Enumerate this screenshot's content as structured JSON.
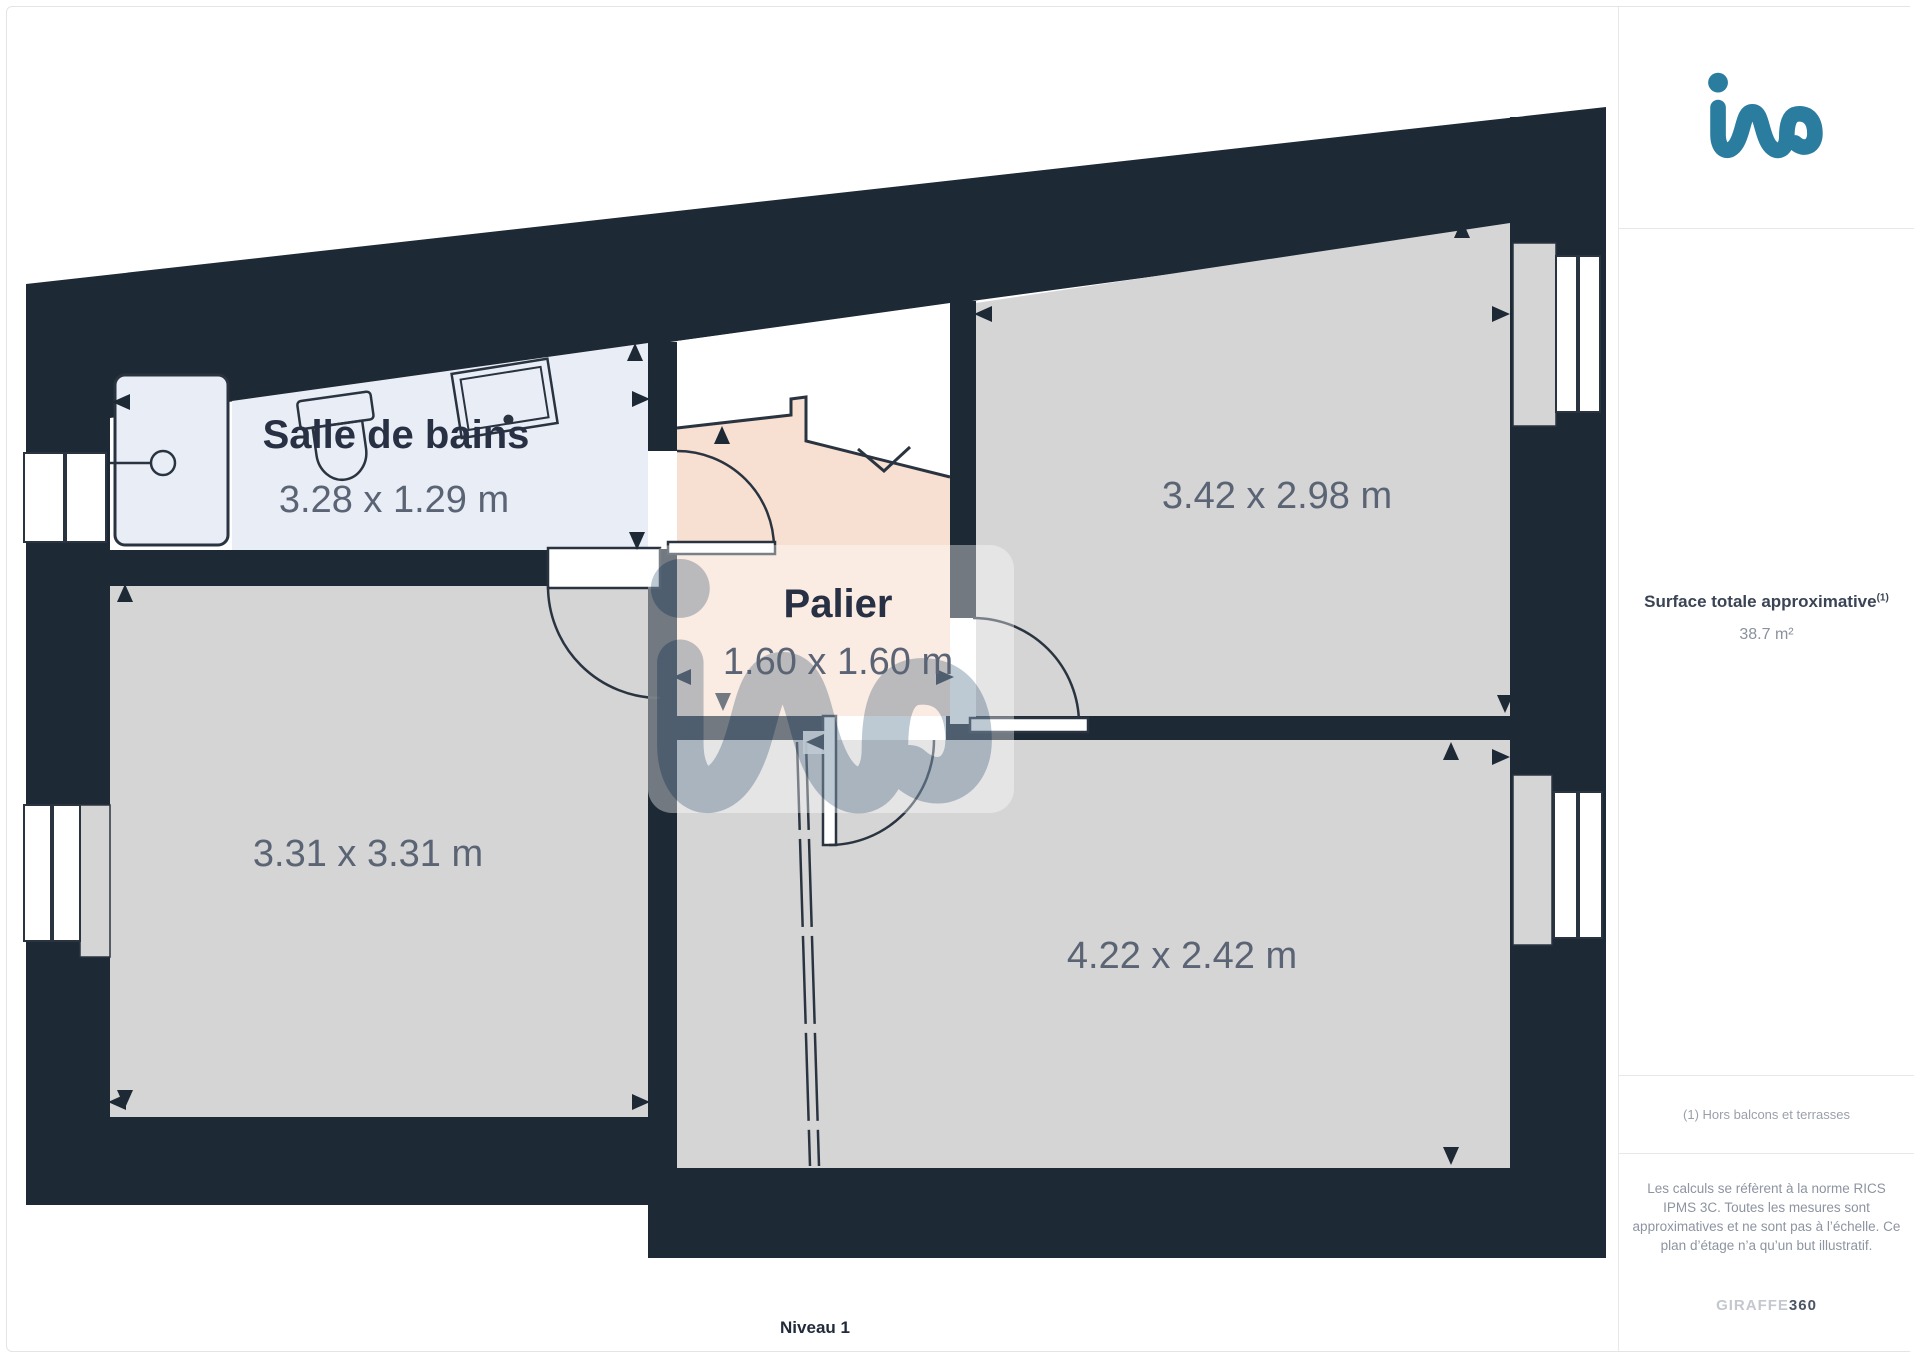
{
  "floorplan": {
    "level_label": "Niveau 1",
    "rooms": [
      {
        "name": "Salle de bains",
        "dimensions": "3.28 x 1.29 m"
      },
      {
        "name": "Palier",
        "dimensions": "1.60 x 1.60 m"
      },
      {
        "name": "",
        "dimensions": "3.42 x 2.98 m"
      },
      {
        "name": "",
        "dimensions": "3.31 x 3.31 m"
      },
      {
        "name": "",
        "dimensions": "4.22 x 2.42 m"
      }
    ],
    "colors": {
      "wall": "#1e2936",
      "room": "#d5d5d5",
      "bathroom": "#e9edf6",
      "landing": "#f7dfd2",
      "accent": "#2b7d9f"
    }
  },
  "sidebar": {
    "surface_label": "Surface totale approximative",
    "surface_sup": "(1)",
    "surface_value": "38.7 m²",
    "footnote": "(1) Hors balcons et terrasses",
    "disclaimer": "Les calculs se réfèrent à la norme RICS IPMS 3C. Toutes les mesures sont approximatives et ne sont pas à l’échelle. Ce plan d’étage n’a qu’un but illustratif.",
    "brand": "GIRAFFE",
    "brand_suffix": "360"
  }
}
